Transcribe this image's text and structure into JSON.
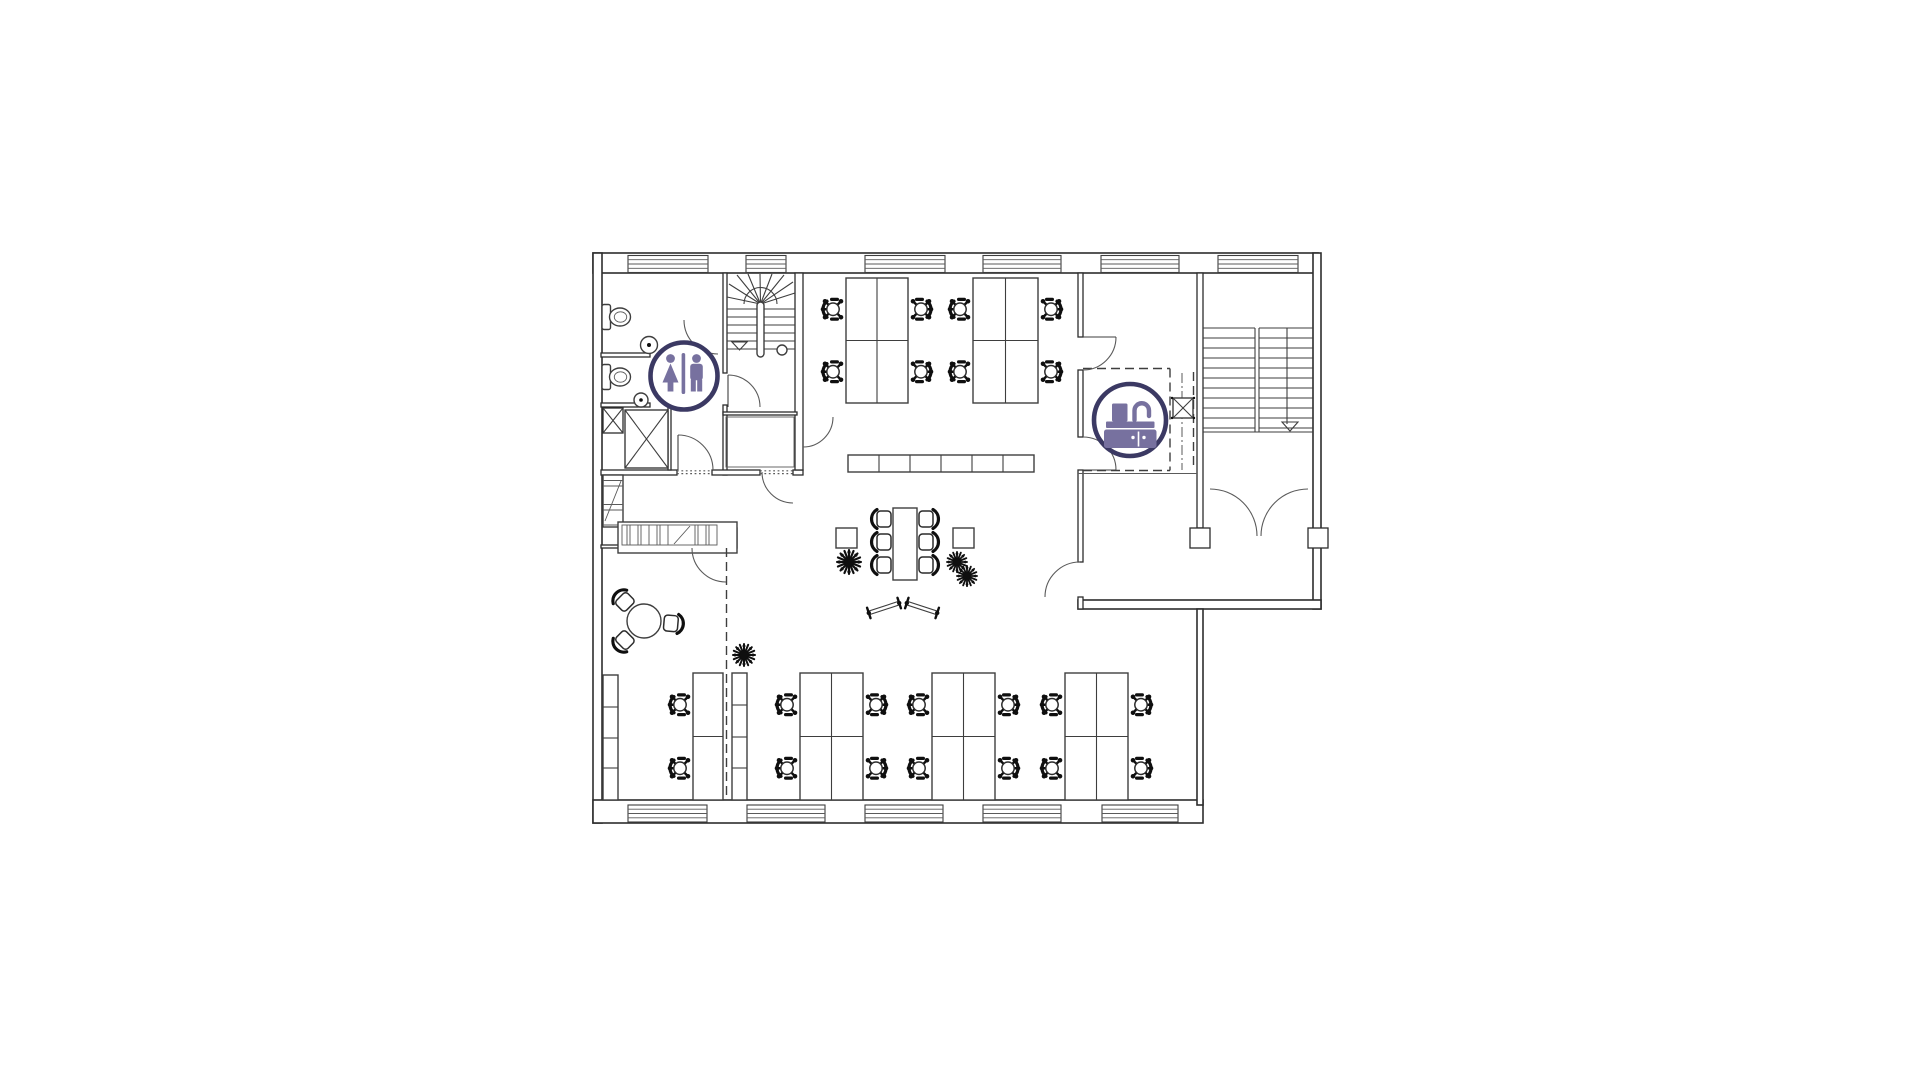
{
  "meta": {
    "page_title": "Office floor plan",
    "type": "architectural-floor-plan",
    "canvas": {
      "width": 1921,
      "height": 1081
    }
  },
  "colors": {
    "background": "#ffffff",
    "wall": "#2d2d2d",
    "line": "#3e3e3e",
    "thin": "#5a5a5a",
    "object": "#0f0f0f",
    "badge_ring": "#3b3963",
    "badge_glyph": "#77719f"
  },
  "badges": [
    {
      "id": "restroom",
      "icon": "wc-woman-man-icon",
      "label": "Restrooms",
      "cx": 684,
      "cy": 376,
      "r": 33.5
    },
    {
      "id": "kitchen",
      "icon": "kitchen-sink-icon",
      "label": "Kitchenette",
      "cx": 1130,
      "cy": 420,
      "r": 36
    }
  ],
  "inventory": {
    "desk_clusters": 6,
    "desks": 22,
    "task_chairs": 22,
    "meeting_table_seats": 6,
    "lounge_table_seats": 3,
    "plants": 3,
    "easels": 2,
    "toilets": 2,
    "staircases": 2,
    "shafts": 2,
    "entrance": "double-door",
    "windows_top": 6,
    "windows_bottom": 5
  },
  "plan": {
    "windows": {
      "h": 17,
      "top_y": 255.5,
      "bottom_y": 805,
      "top": [
        [
          628,
          80
        ],
        [
          746,
          40
        ],
        [
          865,
          80
        ],
        [
          983,
          78
        ],
        [
          1101,
          78
        ],
        [
          1218,
          80
        ]
      ],
      "bottom": [
        [
          628,
          79
        ],
        [
          747,
          78
        ],
        [
          865,
          78
        ],
        [
          983,
          78
        ],
        [
          1102,
          76
        ]
      ]
    },
    "desk_clusters": [
      {
        "x": 846,
        "y": 278,
        "w": 62,
        "h": 125,
        "cols": 2,
        "chairs": "lr"
      },
      {
        "x": 973,
        "y": 278,
        "w": 65,
        "h": 125,
        "cols": 2,
        "chairs": "lr"
      },
      {
        "x": 800,
        "y": 673,
        "w": 63,
        "h": 127,
        "cols": 2,
        "chairs": "lr"
      },
      {
        "x": 932,
        "y": 673,
        "w": 63,
        "h": 127,
        "cols": 2,
        "chairs": "lr"
      },
      {
        "x": 1065,
        "y": 673,
        "w": 63,
        "h": 127,
        "cols": 2,
        "chairs": "lr"
      },
      {
        "x": 693,
        "y": 673,
        "w": 30,
        "h": 127,
        "cols": 1,
        "chairs": "l"
      }
    ],
    "cabinet_columns": [
      {
        "x": 603,
        "y": 675,
        "w": 15,
        "h": 125,
        "segs": [
          707,
          738,
          768
        ]
      },
      {
        "x": 732,
        "y": 673,
        "w": 15,
        "h": 127,
        "segs": [
          705,
          737,
          768
        ]
      }
    ],
    "sideboard": {
      "x": 848,
      "y": 455,
      "w": 186,
      "h": 17,
      "dividers": [
        879,
        910,
        941,
        972,
        1003
      ]
    },
    "meeting": {
      "table": {
        "x": 893,
        "y": 508,
        "w": 24,
        "h": 72
      },
      "chairs": [
        [
          884,
          519,
          0
        ],
        [
          884,
          542,
          0
        ],
        [
          884,
          565,
          0
        ],
        [
          926,
          519,
          180
        ],
        [
          926,
          542,
          180
        ],
        [
          926,
          565,
          180
        ]
      ]
    },
    "side_tables": [
      [
        836,
        528,
        21,
        20
      ],
      [
        953,
        528,
        21,
        20
      ]
    ],
    "round_table": {
      "cx": 644,
      "cy": 621,
      "r": 17,
      "chair_angles": [
        225,
        5,
        135
      ],
      "chair_radius": 27
    },
    "plants": [
      [
        849,
        562,
        13
      ],
      [
        957,
        562,
        11
      ],
      [
        967,
        576,
        11
      ],
      [
        744,
        655,
        12
      ]
    ],
    "easels": [
      [
        884,
        608,
        -18
      ],
      [
        922,
        608,
        18
      ]
    ]
  }
}
